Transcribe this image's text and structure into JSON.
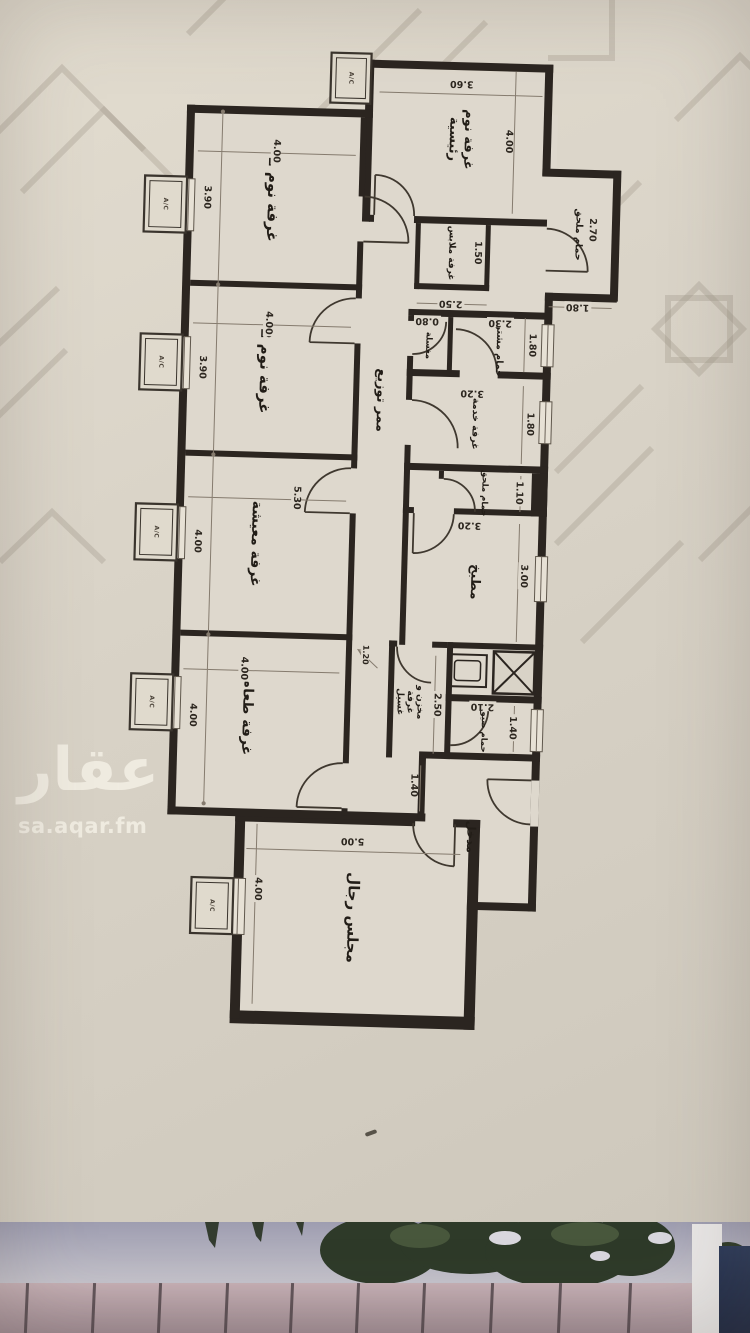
{
  "watermark": {
    "logo": "عقار",
    "site": "sa.aqar.fm"
  },
  "plan": {
    "ac_label": "A/C",
    "corridor": {
      "name": "ممر توزيع"
    },
    "rooms": {
      "master": {
        "name": "غرفة نوم رئيسية",
        "w": "3.60",
        "h": "4.00"
      },
      "master_bath": {
        "name": "حمام ملحق",
        "w": "1.80",
        "h": "2.70"
      },
      "closet": {
        "name": "غرفة ملابس",
        "w": "2.50",
        "h": "1.50"
      },
      "bed1": {
        "name": "غرفة نوم 1",
        "w": "4.00",
        "h": "3.90"
      },
      "bed2": {
        "name": "غرفة نوم 2",
        "w": "4.00",
        "h": "3.90"
      },
      "living": {
        "name": "غرفة معيشة",
        "w": "5.30",
        "h": "4.00"
      },
      "dining": {
        "name": "غرفة طعام",
        "w": "4.00",
        "h": "4.00"
      },
      "sink": {
        "name": "مغسلة",
        "w": "0.80"
      },
      "shared_bath": {
        "name": "حمام مشترك",
        "w": "2.30",
        "h": "1.80"
      },
      "service": {
        "name": "غرفة خدمة",
        "w": "3.20",
        "h": "1.80"
      },
      "small_bath": {
        "name": "حمام ملحق",
        "h": "1.10"
      },
      "kitchen": {
        "name": "مطبخ",
        "w": "3.20",
        "h": "3.00"
      },
      "laundry": {
        "name": "مخزن و غرفة غسيل",
        "h": "2.50",
        "note": "1.20"
      },
      "guest_bath": {
        "name": "حمام ضيوف",
        "w": "2.10",
        "h": "1.40"
      },
      "entrance": {
        "name": "مدخل",
        "h": "1.40"
      },
      "majlis": {
        "name": "مجلس رجال",
        "w": "5.00",
        "h": "4.00"
      }
    }
  }
}
